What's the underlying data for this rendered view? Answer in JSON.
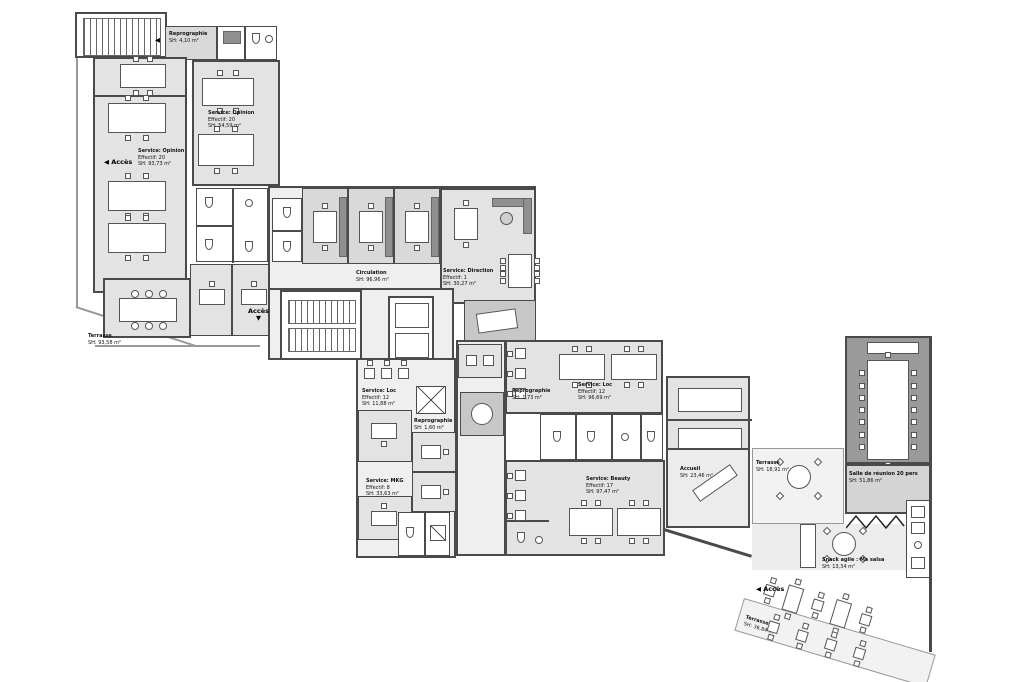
{
  "plan": {
    "acces_label": "Accès",
    "arrow_left": "◀",
    "arrow_down": "▼",
    "colors": {
      "wall": "#4a4a4a",
      "room_fill": "#e3e3e3",
      "corridor_fill": "#efefef",
      "office_fill": "#d9d9d9",
      "dark_room_fill": "#9a9a9a",
      "terrace_fill": "#f2f2f2"
    }
  },
  "rooms": {
    "repro_top": {
      "l1": "Reprographie",
      "l2": "SH:  4,10 m²"
    },
    "opinion_right": {
      "l1": "Service: Opinion",
      "l2": "Effectif:  20",
      "l3": "SH:  54,59 m²"
    },
    "opinion_left": {
      "l1": "Service: Opinion",
      "l2": "Effectif:  20",
      "l3": "SH:  93,73 m²"
    },
    "terrasse_left": {
      "l1": "Terrasse",
      "l2": "SH: 93,58 m²"
    },
    "circulation": {
      "l1": "Circulation",
      "l2": "SH: 96,96 m²"
    },
    "direction": {
      "l1": "Service: Direction",
      "l2": "Effectif:  1",
      "l3": "SH:  30,27 m²"
    },
    "repro_core": {
      "l1": "Reprographie",
      "l2": "SH:  1,60 m²"
    },
    "loc_small": {
      "l1": "Service: Loc",
      "l2": "Effectif:  12",
      "l3": "SH:  11,88 m²"
    },
    "mkg": {
      "l1": "Service: MKG",
      "l2": "Effectif:  8",
      "l3": "SH:  33,63 m²"
    },
    "repro_right": {
      "l1": "Reprographie",
      "l2": "SH:  1,73 m²"
    },
    "loc": {
      "l1": "Service: Loc",
      "l2": "Effectif:  12",
      "l3": "SH:  96,69 m²"
    },
    "beauty": {
      "l1": "Service: Beauty",
      "l2": "Effectif:  17",
      "l3": "SH:  97,47 m²"
    },
    "accueil": {
      "l1": "Accueil",
      "l2": "SH: 23,46 m²"
    },
    "terrasse_mid": {
      "l1": "Terrasse",
      "l2": "SH: 18,91 m²"
    },
    "reunion": {
      "l1": "Salle de réunion 20 pers",
      "l2": "SH:  51,86 m²"
    },
    "snack": {
      "l1": "Snack agile : Ma salsa",
      "l2": "SH:  13,34 m²"
    },
    "terrasse_bas": {
      "l1": "Terrasse",
      "l2": "SH: 36,84 m²"
    }
  }
}
